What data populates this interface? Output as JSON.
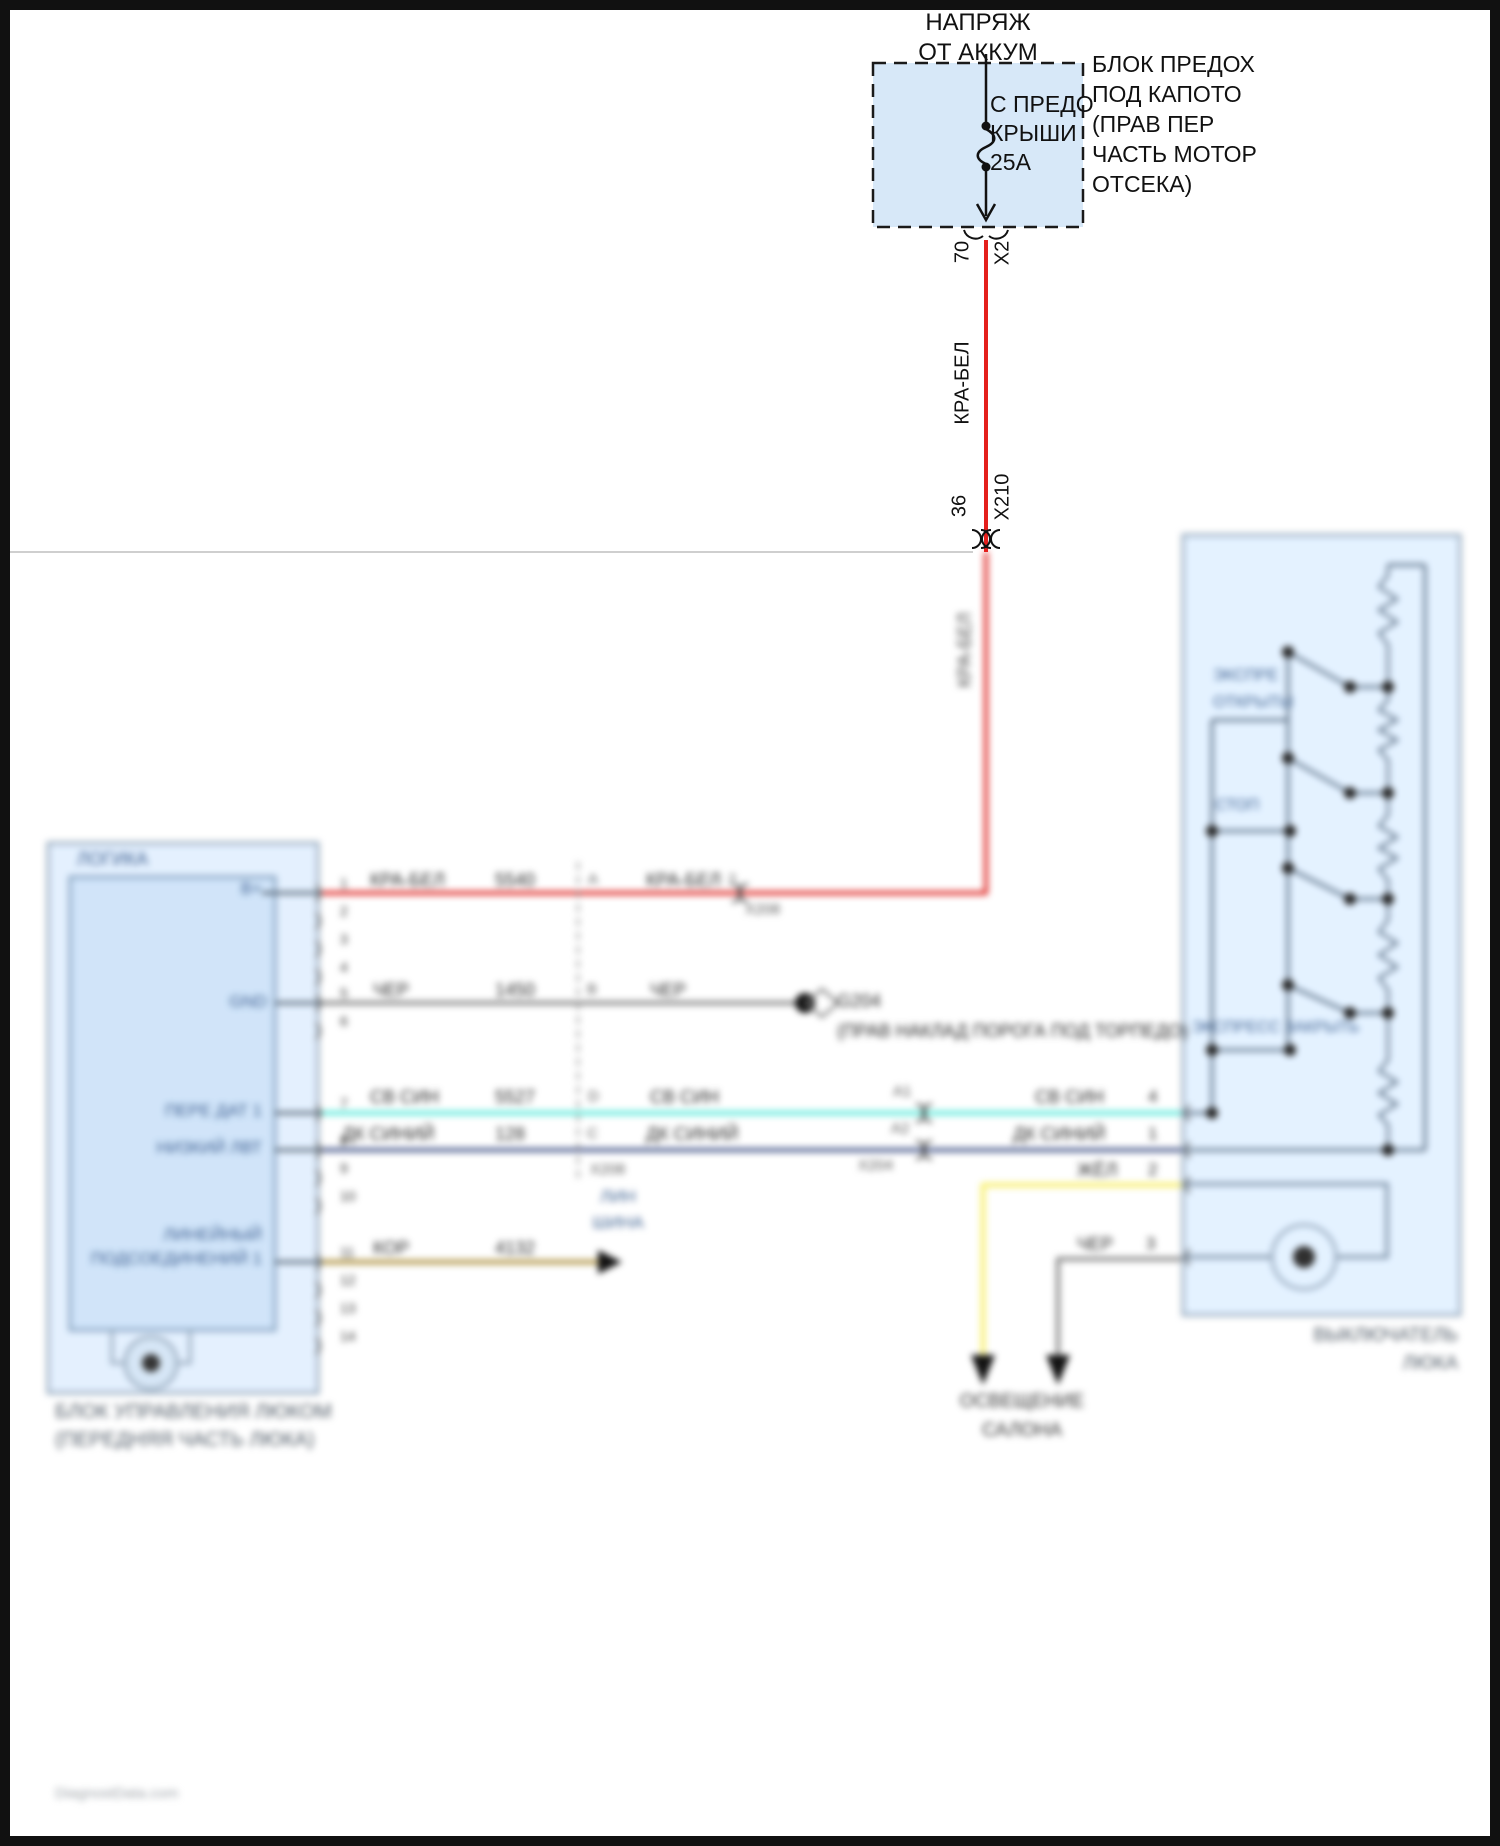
{
  "colors": {
    "wire_red": "#e41f1c",
    "wire_cyan": "#66e8da",
    "wire_dark_blue": "#3d4f86",
    "wire_yellow": "#f2ea6a",
    "wire_gray": "#7d7d7d",
    "wire_brown": "#b49a4e",
    "box_fill_light_blue": "#d9e9f9",
    "box_stroke": "#8fa3b8",
    "component_label_blue": "#3b5f91",
    "caption_gray": "#4f5a66"
  },
  "module_pins": [
    {
      "n": "1",
      "y": 893
    },
    {
      "n": "2",
      "y": 921
    },
    {
      "n": "3",
      "y": 949
    },
    {
      "n": "4",
      "y": 977
    },
    {
      "n": "5",
      "y": 1003
    },
    {
      "n": "6",
      "y": 1031
    },
    {
      "n": "7",
      "y": 1113
    },
    {
      "n": "8",
      "y": 1150
    },
    {
      "n": "9",
      "y": 1178
    },
    {
      "n": "10",
      "y": 1206
    },
    {
      "n": "11",
      "y": 1262
    },
    {
      "n": "12",
      "y": 1290
    },
    {
      "n": "13",
      "y": 1318
    },
    {
      "n": "14",
      "y": 1346
    }
  ],
  "labels": [
    {
      "id": "battery-feed-line-1",
      "layer": "sharp",
      "text": "НАПРЯЖ",
      "x": 978,
      "y": 10,
      "fs": 24,
      "align": "c",
      "color": "#111111"
    },
    {
      "id": "battery-feed-line-2",
      "layer": "sharp",
      "text": "ОТ АККУМ",
      "x": 978,
      "y": 40,
      "fs": 24,
      "align": "c",
      "color": "#111111"
    },
    {
      "id": "fuse-name-line-1",
      "layer": "sharp",
      "text": "С ПРЕДО",
      "x": 990,
      "y": 92,
      "fs": 23,
      "align": "l",
      "color": "#111111"
    },
    {
      "id": "fuse-name-line-2",
      "layer": "sharp",
      "text": "КРЫШИ",
      "x": 990,
      "y": 121,
      "fs": 23,
      "align": "l",
      "color": "#111111"
    },
    {
      "id": "fuse-rating",
      "layer": "sharp",
      "text": "25А",
      "x": 990,
      "y": 150,
      "fs": 23,
      "align": "l",
      "color": "#111111"
    },
    {
      "id": "fusebox-name-line-1",
      "layer": "sharp",
      "text": "БЛОК ПРЕДОХ",
      "x": 1092,
      "y": 52,
      "fs": 23,
      "align": "l",
      "color": "#111111"
    },
    {
      "id": "fusebox-name-line-2",
      "layer": "sharp",
      "text": "ПОД КАПОТО",
      "x": 1092,
      "y": 82,
      "fs": 23,
      "align": "l",
      "color": "#111111"
    },
    {
      "id": "fusebox-name-line-3",
      "layer": "sharp",
      "text": "(ПРАВ ПЕР",
      "x": 1092,
      "y": 112,
      "fs": 23,
      "align": "l",
      "color": "#111111"
    },
    {
      "id": "fusebox-name-line-4",
      "layer": "sharp",
      "text": "ЧАСТЬ МОТОР",
      "x": 1092,
      "y": 142,
      "fs": 23,
      "align": "l",
      "color": "#111111"
    },
    {
      "id": "fusebox-name-line-5",
      "layer": "sharp",
      "text": "ОТСЕКА)",
      "x": 1092,
      "y": 172,
      "fs": 23,
      "align": "l",
      "color": "#111111"
    },
    {
      "id": "fusebox-pin-70",
      "layer": "sharp",
      "text": "70",
      "x": 963,
      "y": 252,
      "fs": 20,
      "align": "c",
      "color": "#111111",
      "rot": -90
    },
    {
      "id": "fusebox-connector-x2",
      "layer": "sharp",
      "text": "X2",
      "x": 1003,
      "y": 253,
      "fs": 20,
      "align": "c",
      "color": "#111111",
      "rot": -90
    },
    {
      "id": "wire-red-vertical-label",
      "layer": "sharp",
      "text": "КРА-БЕЛ",
      "x": 963,
      "y": 383,
      "fs": 20,
      "align": "c",
      "color": "#111111",
      "rot": -90
    },
    {
      "id": "connector-x210-pin-36",
      "layer": "sharp",
      "text": "36",
      "x": 960,
      "y": 506,
      "fs": 20,
      "align": "c",
      "color": "#111111",
      "rot": -90
    },
    {
      "id": "connector-x210",
      "layer": "sharp",
      "text": "X210",
      "x": 1003,
      "y": 497,
      "fs": 20,
      "align": "c",
      "color": "#111111",
      "rot": -90
    },
    {
      "id": "wire-red-vertical-label-2",
      "layer": "blur",
      "text": "КРА-БЕЛ",
      "x": 965,
      "y": 650,
      "fs": 18,
      "align": "c",
      "color": "#454545",
      "rot": -90
    },
    {
      "id": "module-section-logic",
      "layer": "blur",
      "text": "ЛОГИКА",
      "x": 77,
      "y": 850,
      "fs": 18,
      "align": "l",
      "color": "#3b5f91"
    },
    {
      "id": "module-pin-bplus",
      "layer": "blur",
      "text": "B+",
      "x": 262,
      "y": 880,
      "fs": 17,
      "align": "r",
      "color": "#3b5f91"
    },
    {
      "id": "module-pin-gnd",
      "layer": "blur",
      "text": "GND",
      "x": 267,
      "y": 993,
      "fs": 17,
      "align": "r",
      "color": "#3b5f91"
    },
    {
      "id": "module-pin-pere-dat",
      "layer": "blur",
      "text": "ПЕРЕ ДАТ 1",
      "x": 262,
      "y": 1102,
      "fs": 17,
      "align": "r",
      "color": "#3b5f91"
    },
    {
      "id": "module-pin-nizkiy",
      "layer": "blur",
      "text": "НИЗКИЙ ЛВТ",
      "x": 262,
      "y": 1139,
      "fs": 17,
      "align": "r",
      "color": "#3b5f91"
    },
    {
      "id": "module-pin-lin-line-1",
      "layer": "blur",
      "text": "ЛИНЕЙНЫЙ",
      "x": 262,
      "y": 1226,
      "fs": 17,
      "align": "r",
      "color": "#3b5f91"
    },
    {
      "id": "module-pin-lin-line-2",
      "layer": "blur",
      "text": "ПОДСОЕДИНЕНИЙ 1",
      "x": 262,
      "y": 1250,
      "fs": 17,
      "align": "r",
      "color": "#3b5f91"
    },
    {
      "id": "wire-red-label-1",
      "layer": "blur",
      "text": "КРА-БЕЛ",
      "x": 370,
      "y": 871,
      "fs": 18,
      "align": "l",
      "color": "#2b2b2b"
    },
    {
      "id": "wire-red-circuit",
      "layer": "blur",
      "text": "5540",
      "x": 495,
      "y": 871,
      "fs": 18,
      "align": "l",
      "color": "#2b2b2b"
    },
    {
      "id": "connector-x208-pin-a",
      "layer": "blur",
      "text": "A",
      "x": 588,
      "y": 872,
      "fs": 15,
      "align": "l",
      "color": "#555555"
    },
    {
      "id": "wire-red-label-2",
      "layer": "blur",
      "text": "КРА-БЕЛ",
      "x": 646,
      "y": 871,
      "fs": 18,
      "align": "l",
      "color": "#2b2b2b"
    },
    {
      "id": "connector-inline-pin-2",
      "layer": "blur",
      "text": "2",
      "x": 728,
      "y": 872,
      "fs": 15,
      "align": "l",
      "color": "#555555"
    },
    {
      "id": "connector-inline-x208",
      "layer": "blur",
      "text": "X208",
      "x": 745,
      "y": 902,
      "fs": 15,
      "align": "l",
      "color": "#555555"
    },
    {
      "id": "wire-black-label-1",
      "layer": "blur",
      "text": "ЧЕР",
      "x": 373,
      "y": 981,
      "fs": 18,
      "align": "l",
      "color": "#2b2b2b"
    },
    {
      "id": "wire-black-circuit",
      "layer": "blur",
      "text": "1450",
      "x": 495,
      "y": 981,
      "fs": 18,
      "align": "l",
      "color": "#2b2b2b"
    },
    {
      "id": "connector-x208-pin-b",
      "layer": "blur",
      "text": "B",
      "x": 587,
      "y": 982,
      "fs": 15,
      "align": "l",
      "color": "#555555"
    },
    {
      "id": "wire-black-label-2",
      "layer": "blur",
      "text": "ЧЕР",
      "x": 650,
      "y": 981,
      "fs": 18,
      "align": "l",
      "color": "#2b2b2b"
    },
    {
      "id": "ground-id",
      "layer": "blur",
      "text": "G204",
      "x": 837,
      "y": 992,
      "fs": 18,
      "align": "l",
      "color": "#2b2b2b"
    },
    {
      "id": "ground-location",
      "layer": "blur",
      "text": "(ПРАВ НАКЛАД ПОРОГА ПОД ТОРПЕДО)",
      "x": 837,
      "y": 1022,
      "fs": 18,
      "align": "l",
      "color": "#2b2b2b"
    },
    {
      "id": "wire-ltblue-label-1",
      "layer": "blur",
      "text": "СВ СИН",
      "x": 370,
      "y": 1088,
      "fs": 18,
      "align": "l",
      "color": "#2b2b2b"
    },
    {
      "id": "wire-ltblue-circuit",
      "layer": "blur",
      "text": "5527",
      "x": 495,
      "y": 1088,
      "fs": 18,
      "align": "l",
      "color": "#2b2b2b"
    },
    {
      "id": "connector-x208-pin-d",
      "layer": "blur",
      "text": "D",
      "x": 588,
      "y": 1089,
      "fs": 15,
      "align": "l",
      "color": "#555555"
    },
    {
      "id": "wire-ltblue-label-2",
      "layer": "blur",
      "text": "СВ СИН",
      "x": 650,
      "y": 1088,
      "fs": 18,
      "align": "l",
      "color": "#2b2b2b"
    },
    {
      "id": "connector-x204-pin-a1",
      "layer": "blur",
      "text": "A1",
      "x": 893,
      "y": 1084,
      "fs": 15,
      "align": "l",
      "color": "#555555"
    },
    {
      "id": "wire-ltblue-label-3",
      "layer": "blur",
      "text": "СВ СИН",
      "x": 1035,
      "y": 1088,
      "fs": 18,
      "align": "l",
      "color": "#2b2b2b"
    },
    {
      "id": "switch-pin-4",
      "layer": "blur",
      "text": "4",
      "x": 1148,
      "y": 1088,
      "fs": 17,
      "align": "l",
      "color": "#2b2b2b"
    },
    {
      "id": "wire-dkblue-label-1",
      "layer": "blur",
      "text": "ДК СИНИЙ",
      "x": 342,
      "y": 1125,
      "fs": 18,
      "align": "l",
      "color": "#2b2b2b"
    },
    {
      "id": "wire-dkblue-circuit",
      "layer": "blur",
      "text": "128",
      "x": 495,
      "y": 1125,
      "fs": 18,
      "align": "l",
      "color": "#2b2b2b"
    },
    {
      "id": "connector-x208-pin-c",
      "layer": "blur",
      "text": "C",
      "x": 587,
      "y": 1126,
      "fs": 15,
      "align": "l",
      "color": "#555555"
    },
    {
      "id": "wire-dkblue-label-2",
      "layer": "blur",
      "text": "ДК СИНИЙ",
      "x": 646,
      "y": 1125,
      "fs": 18,
      "align": "l",
      "color": "#2b2b2b"
    },
    {
      "id": "connector-x204-pin-a2",
      "layer": "blur",
      "text": "A2",
      "x": 891,
      "y": 1121,
      "fs": 15,
      "align": "l",
      "color": "#555555"
    },
    {
      "id": "wire-dkblue-label-3",
      "layer": "blur",
      "text": "ДК СИНИЙ",
      "x": 1013,
      "y": 1125,
      "fs": 18,
      "align": "l",
      "color": "#2b2b2b"
    },
    {
      "id": "switch-pin-1",
      "layer": "blur",
      "text": "1",
      "x": 1148,
      "y": 1125,
      "fs": 17,
      "align": "l",
      "color": "#2b2b2b"
    },
    {
      "id": "connector-x208-name",
      "layer": "blur",
      "text": "X208",
      "x": 590,
      "y": 1162,
      "fs": 15,
      "align": "l",
      "color": "#555555"
    },
    {
      "id": "connector-x204-name",
      "layer": "blur",
      "text": "X204",
      "x": 858,
      "y": 1158,
      "fs": 15,
      "align": "l",
      "color": "#555555"
    },
    {
      "id": "wire-yellow-label",
      "layer": "blur",
      "text": "ЖЁЛ",
      "x": 1077,
      "y": 1161,
      "fs": 18,
      "align": "l",
      "color": "#2b2b2b"
    },
    {
      "id": "switch-pin-2",
      "layer": "blur",
      "text": "2",
      "x": 1148,
      "y": 1161,
      "fs": 17,
      "align": "l",
      "color": "#2b2b2b"
    },
    {
      "id": "wire-black2-label",
      "layer": "blur",
      "text": "ЧЕР",
      "x": 1077,
      "y": 1235,
      "fs": 18,
      "align": "l",
      "color": "#2b2b2b"
    },
    {
      "id": "switch-pin-3",
      "layer": "blur",
      "text": "3",
      "x": 1146,
      "y": 1235,
      "fs": 17,
      "align": "l",
      "color": "#2b2b2b"
    },
    {
      "id": "wire-brown-label",
      "layer": "blur",
      "text": "КОР",
      "x": 373,
      "y": 1239,
      "fs": 18,
      "align": "l",
      "color": "#2b2b2b"
    },
    {
      "id": "wire-brown-circuit",
      "layer": "blur",
      "text": "4132",
      "x": 495,
      "y": 1239,
      "fs": 18,
      "align": "l",
      "color": "#2b2b2b"
    },
    {
      "id": "lin-bus-line-1",
      "layer": "blur",
      "text": "ЛИН",
      "x": 618,
      "y": 1188,
      "fs": 17,
      "align": "c",
      "color": "#3b5f91"
    },
    {
      "id": "lin-bus-line-2",
      "layer": "blur",
      "text": "ШИНА",
      "x": 618,
      "y": 1214,
      "fs": 17,
      "align": "c",
      "color": "#3b5f91"
    },
    {
      "id": "interior-lighting-line-1",
      "layer": "blur",
      "text": "ОСВЕЩЕНИЕ",
      "x": 1022,
      "y": 1392,
      "fs": 19,
      "align": "c",
      "color": "#333333"
    },
    {
      "id": "interior-lighting-line-2",
      "layer": "blur",
      "text": "САЛОНА",
      "x": 1022,
      "y": 1421,
      "fs": 19,
      "align": "c",
      "color": "#333333"
    },
    {
      "id": "switch-express-open-line-1",
      "layer": "blur",
      "text": "ЭКСПРЕ",
      "x": 1213,
      "y": 668,
      "fs": 16,
      "align": "l",
      "color": "#3b5f91"
    },
    {
      "id": "switch-express-open-line-2",
      "layer": "blur",
      "text": "ОТКРЫТЫ",
      "x": 1213,
      "y": 695,
      "fs": 16,
      "align": "l",
      "color": "#3b5f91"
    },
    {
      "id": "switch-stop",
      "layer": "blur",
      "text": "СТОП",
      "x": 1215,
      "y": 798,
      "fs": 16,
      "align": "l",
      "color": "#3b5f91"
    },
    {
      "id": "switch-express-close",
      "layer": "blur",
      "text": "ЭКСПРЕСС ЗАКРЫТЬ",
      "x": 1192,
      "y": 1020,
      "fs": 16,
      "align": "l",
      "color": "#3b5f91"
    },
    {
      "id": "module-caption-line-1",
      "layer": "blur",
      "text": "БЛОК УПРАВЛЕНИЯ ЛЮКОМ",
      "x": 55,
      "y": 1402,
      "fs": 20,
      "align": "l",
      "color": "#4f5a66"
    },
    {
      "id": "module-caption-line-2",
      "layer": "blur",
      "text": "(ПЕРЕДНЯЯ ЧАСТЬ ЛЮКА)",
      "x": 55,
      "y": 1430,
      "fs": 20,
      "align": "l",
      "color": "#4f5a66"
    },
    {
      "id": "switch-caption-line-1",
      "layer": "blur",
      "text": "ВЫКЛЮЧАТЕЛЬ",
      "x": 1458,
      "y": 1326,
      "fs": 19,
      "align": "r",
      "color": "#4f5a66"
    },
    {
      "id": "switch-caption-line-2",
      "layer": "blur",
      "text": "ЛЮКА",
      "x": 1458,
      "y": 1354,
      "fs": 19,
      "align": "r",
      "color": "#4f5a66"
    },
    {
      "id": "watermark",
      "layer": "blur",
      "text": "DiagnostData.com",
      "x": 55,
      "y": 1786,
      "fs": 15,
      "align": "l",
      "color": "#9aa0a6"
    }
  ]
}
